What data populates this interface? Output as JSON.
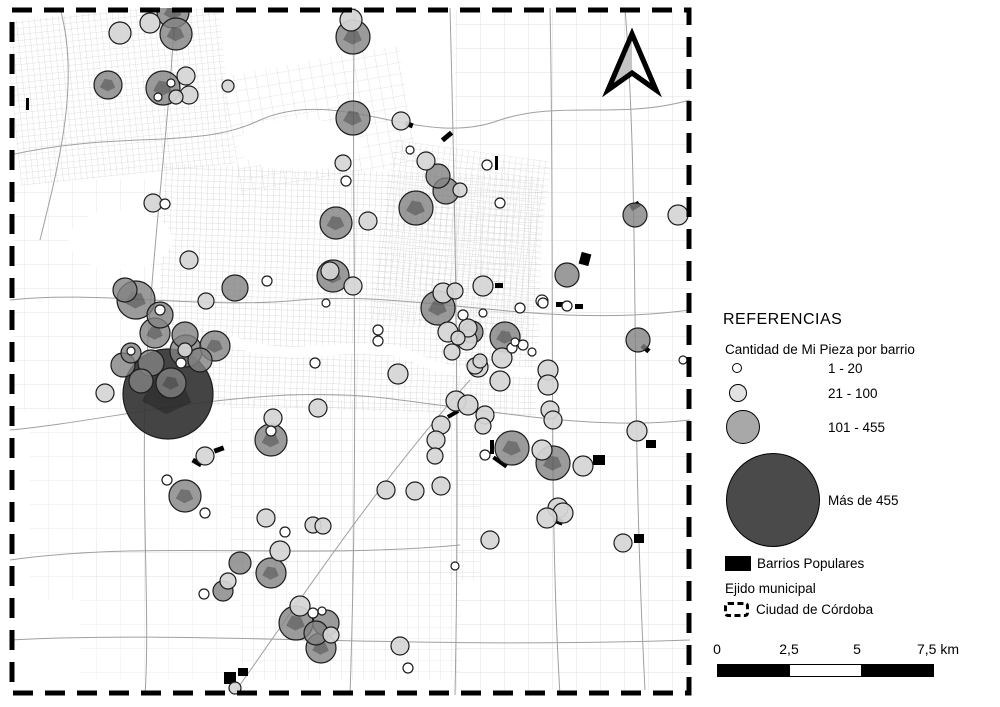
{
  "legend": {
    "title": "REFERENCIAS",
    "subtitle": "Cantidad de Mi Pieza por barrio",
    "items": [
      {
        "label": "1 - 20",
        "color": "#ffffff"
      },
      {
        "label": "21 - 100",
        "color": "#e2e2e2"
      },
      {
        "label": "101 - 455",
        "color": "#a8a8a8"
      },
      {
        "label": "Más de 455",
        "color": "#4a4a4a"
      }
    ],
    "barrios_label": "Barrios Populares",
    "ejido_title": "Ejido municipal",
    "ejido_label": "Ciudad de Córdoba"
  },
  "scalebar": {
    "labels": [
      "0",
      "2,5",
      "5",
      "7,5 km"
    ],
    "segment_colors": [
      "#000000",
      "#ffffff",
      "#000000"
    ]
  },
  "map": {
    "boundary_color": "#000000",
    "palette": {
      "s": "#ffffff",
      "l": "rgba(213,213,213,0.93)",
      "m": "rgba(130,130,130,0.8)",
      "xl": "rgba(52,52,52,0.92)"
    },
    "symbols": [
      [
        120,
        33,
        11,
        "l"
      ],
      [
        150,
        23,
        10,
        "l"
      ],
      [
        173,
        12,
        16,
        "m"
      ],
      [
        176,
        34,
        16,
        "m"
      ],
      [
        108,
        85,
        14,
        "m"
      ],
      [
        163,
        88,
        17,
        "m"
      ],
      [
        186,
        76,
        9,
        "l"
      ],
      [
        189,
        95,
        9,
        "l"
      ],
      [
        176,
        97,
        7,
        "l"
      ],
      [
        171,
        83,
        4,
        "s"
      ],
      [
        158,
        97,
        4,
        "s"
      ],
      [
        228,
        86,
        6,
        "l"
      ],
      [
        351,
        20,
        11,
        "l"
      ],
      [
        353,
        37,
        17,
        "m"
      ],
      [
        353,
        118,
        17,
        "m"
      ],
      [
        401,
        121,
        9,
        "l"
      ],
      [
        410,
        150,
        4,
        "s"
      ],
      [
        426,
        161,
        9,
        "l"
      ],
      [
        438,
        176,
        12,
        "m"
      ],
      [
        343,
        163,
        8,
        "l"
      ],
      [
        487,
        165,
        5,
        "s"
      ],
      [
        153,
        203,
        9,
        "l"
      ],
      [
        165,
        204,
        5,
        "s"
      ],
      [
        189,
        260,
        9,
        "l"
      ],
      [
        206,
        301,
        8,
        "l"
      ],
      [
        235,
        288,
        13,
        "m"
      ],
      [
        125,
        290,
        12,
        "m"
      ],
      [
        136,
        300,
        19,
        "m"
      ],
      [
        160,
        315,
        13,
        "m"
      ],
      [
        160,
        310,
        5,
        "s"
      ],
      [
        155,
        333,
        15,
        "m"
      ],
      [
        185,
        335,
        13,
        "m"
      ],
      [
        186,
        351,
        16,
        "m"
      ],
      [
        185,
        350,
        7,
        "l"
      ],
      [
        131,
        353,
        10,
        "m"
      ],
      [
        131,
        351,
        4,
        "s"
      ],
      [
        123,
        365,
        12,
        "m"
      ],
      [
        151,
        363,
        13,
        "m"
      ],
      [
        181,
        363,
        5,
        "s"
      ],
      [
        200,
        360,
        12,
        "m"
      ],
      [
        215,
        346,
        15,
        "m"
      ],
      [
        346,
        181,
        5,
        "s"
      ],
      [
        336,
        223,
        16,
        "m"
      ],
      [
        368,
        221,
        9,
        "l"
      ],
      [
        416,
        208,
        17,
        "m"
      ],
      [
        446,
        191,
        13,
        "m"
      ],
      [
        460,
        190,
        7,
        "l"
      ],
      [
        333,
        276,
        16,
        "m"
      ],
      [
        330,
        271,
        9,
        "l"
      ],
      [
        353,
        286,
        9,
        "l"
      ],
      [
        267,
        281,
        5,
        "s"
      ],
      [
        326,
        303,
        4,
        "s"
      ],
      [
        438,
        308,
        17,
        "m"
      ],
      [
        443,
        293,
        10,
        "l"
      ],
      [
        455,
        291,
        8,
        "l"
      ],
      [
        458,
        338,
        7,
        "l"
      ],
      [
        378,
        330,
        5,
        "s"
      ],
      [
        378,
        341,
        5,
        "s"
      ],
      [
        315,
        363,
        5,
        "s"
      ],
      [
        398,
        374,
        10,
        "l"
      ],
      [
        483,
        286,
        10,
        "l"
      ],
      [
        463,
        315,
        5,
        "s"
      ],
      [
        483,
        313,
        4,
        "s"
      ],
      [
        520,
        308,
        5,
        "s"
      ],
      [
        543,
        303,
        5,
        "s"
      ],
      [
        468,
        328,
        9,
        "l"
      ],
      [
        448,
        332,
        10,
        "l"
      ],
      [
        467,
        340,
        10,
        "l"
      ],
      [
        452,
        352,
        8,
        "l"
      ],
      [
        505,
        337,
        15,
        "m"
      ],
      [
        502,
        358,
        10,
        "l"
      ],
      [
        515,
        342,
        4,
        "s"
      ],
      [
        523,
        345,
        5,
        "s"
      ],
      [
        532,
        352,
        4,
        "s"
      ],
      [
        478,
        367,
        10,
        "l"
      ],
      [
        548,
        370,
        10,
        "l"
      ],
      [
        472,
        332,
        11,
        "m"
      ],
      [
        512,
        348,
        5,
        "s"
      ],
      [
        480,
        361,
        7,
        "l"
      ],
      [
        475,
        366,
        8,
        "l"
      ],
      [
        542,
        301,
        6,
        "s"
      ],
      [
        567,
        306,
        5,
        "s"
      ],
      [
        500,
        203,
        5,
        "s"
      ],
      [
        635,
        215,
        12,
        "m"
      ],
      [
        678,
        215,
        10,
        "l"
      ],
      [
        567,
        275,
        12,
        "m"
      ],
      [
        638,
        340,
        12,
        "m"
      ],
      [
        683,
        360,
        4,
        "s"
      ],
      [
        168,
        394,
        45,
        "xl"
      ],
      [
        105,
        393,
        9,
        "l"
      ],
      [
        141,
        381,
        12,
        "m"
      ],
      [
        171,
        383,
        15,
        "m"
      ],
      [
        205,
        456,
        9,
        "l"
      ],
      [
        167,
        480,
        5,
        "s"
      ],
      [
        185,
        496,
        16,
        "m"
      ],
      [
        205,
        513,
        5,
        "s"
      ],
      [
        318,
        408,
        9,
        "l"
      ],
      [
        273,
        418,
        9,
        "l"
      ],
      [
        271,
        440,
        16,
        "m"
      ],
      [
        271,
        431,
        5,
        "s"
      ],
      [
        456,
        401,
        10,
        "l"
      ],
      [
        441,
        425,
        9,
        "l"
      ],
      [
        436,
        440,
        9,
        "l"
      ],
      [
        435,
        456,
        8,
        "l"
      ],
      [
        386,
        490,
        9,
        "l"
      ],
      [
        415,
        491,
        9,
        "l"
      ],
      [
        441,
        486,
        9,
        "l"
      ],
      [
        266,
        518,
        9,
        "l"
      ],
      [
        285,
        532,
        5,
        "s"
      ],
      [
        313,
        525,
        8,
        "l"
      ],
      [
        323,
        526,
        8,
        "l"
      ],
      [
        280,
        551,
        10,
        "l"
      ],
      [
        271,
        573,
        15,
        "m"
      ],
      [
        240,
        563,
        11,
        "m"
      ],
      [
        455,
        566,
        4,
        "s"
      ],
      [
        468,
        405,
        10,
        "l"
      ],
      [
        485,
        415,
        9,
        "l"
      ],
      [
        483,
        426,
        8,
        "l"
      ],
      [
        500,
        381,
        10,
        "l"
      ],
      [
        548,
        385,
        10,
        "l"
      ],
      [
        550,
        410,
        9,
        "l"
      ],
      [
        553,
        420,
        9,
        "l"
      ],
      [
        512,
        448,
        17,
        "m"
      ],
      [
        542,
        450,
        10,
        "l"
      ],
      [
        553,
        463,
        17,
        "m"
      ],
      [
        583,
        466,
        10,
        "l"
      ],
      [
        485,
        455,
        5,
        "s"
      ],
      [
        637,
        431,
        10,
        "l"
      ],
      [
        558,
        508,
        10,
        "l"
      ],
      [
        563,
        513,
        10,
        "l"
      ],
      [
        547,
        518,
        10,
        "l"
      ],
      [
        490,
        540,
        9,
        "l"
      ],
      [
        623,
        543,
        9,
        "l"
      ],
      [
        223,
        591,
        10,
        "m"
      ],
      [
        204,
        594,
        5,
        "s"
      ],
      [
        228,
        581,
        8,
        "l"
      ],
      [
        235,
        688,
        6,
        "l"
      ],
      [
        296,
        623,
        17,
        "m"
      ],
      [
        300,
        606,
        10,
        "l"
      ],
      [
        313,
        613,
        5,
        "s"
      ],
      [
        322,
        611,
        4,
        "s"
      ],
      [
        326,
        623,
        13,
        "m"
      ],
      [
        321,
        648,
        15,
        "m"
      ],
      [
        331,
        635,
        8,
        "l"
      ],
      [
        316,
        633,
        12,
        "m"
      ],
      [
        400,
        646,
        9,
        "l"
      ],
      [
        408,
        668,
        5,
        "s"
      ]
    ],
    "barrio_marks": [
      [
        580,
        253,
        10,
        12,
        15
      ],
      [
        593,
        455,
        12,
        10,
        0
      ],
      [
        646,
        440,
        10,
        8,
        0
      ],
      [
        634,
        534,
        10,
        9,
        0
      ],
      [
        490,
        440,
        4,
        14,
        0
      ],
      [
        492,
        460,
        16,
        4,
        35
      ],
      [
        553,
        518,
        10,
        6,
        20
      ],
      [
        447,
        412,
        12,
        4,
        -30
      ],
      [
        441,
        134,
        12,
        5,
        -40
      ],
      [
        405,
        122,
        8,
        5,
        20
      ],
      [
        556,
        302,
        8,
        5,
        0
      ],
      [
        575,
        304,
        8,
        5,
        0
      ],
      [
        192,
        460,
        10,
        5,
        30
      ],
      [
        214,
        447,
        10,
        5,
        -20
      ],
      [
        495,
        156,
        3,
        14,
        0
      ],
      [
        224,
        672,
        12,
        12,
        0
      ],
      [
        238,
        668,
        10,
        8,
        0
      ],
      [
        630,
        203,
        10,
        6,
        -30
      ],
      [
        495,
        283,
        8,
        5,
        0
      ],
      [
        641,
        346,
        9,
        5,
        40
      ],
      [
        26,
        98,
        3,
        12,
        0
      ],
      [
        228,
        697,
        12,
        8,
        0
      ]
    ]
  }
}
